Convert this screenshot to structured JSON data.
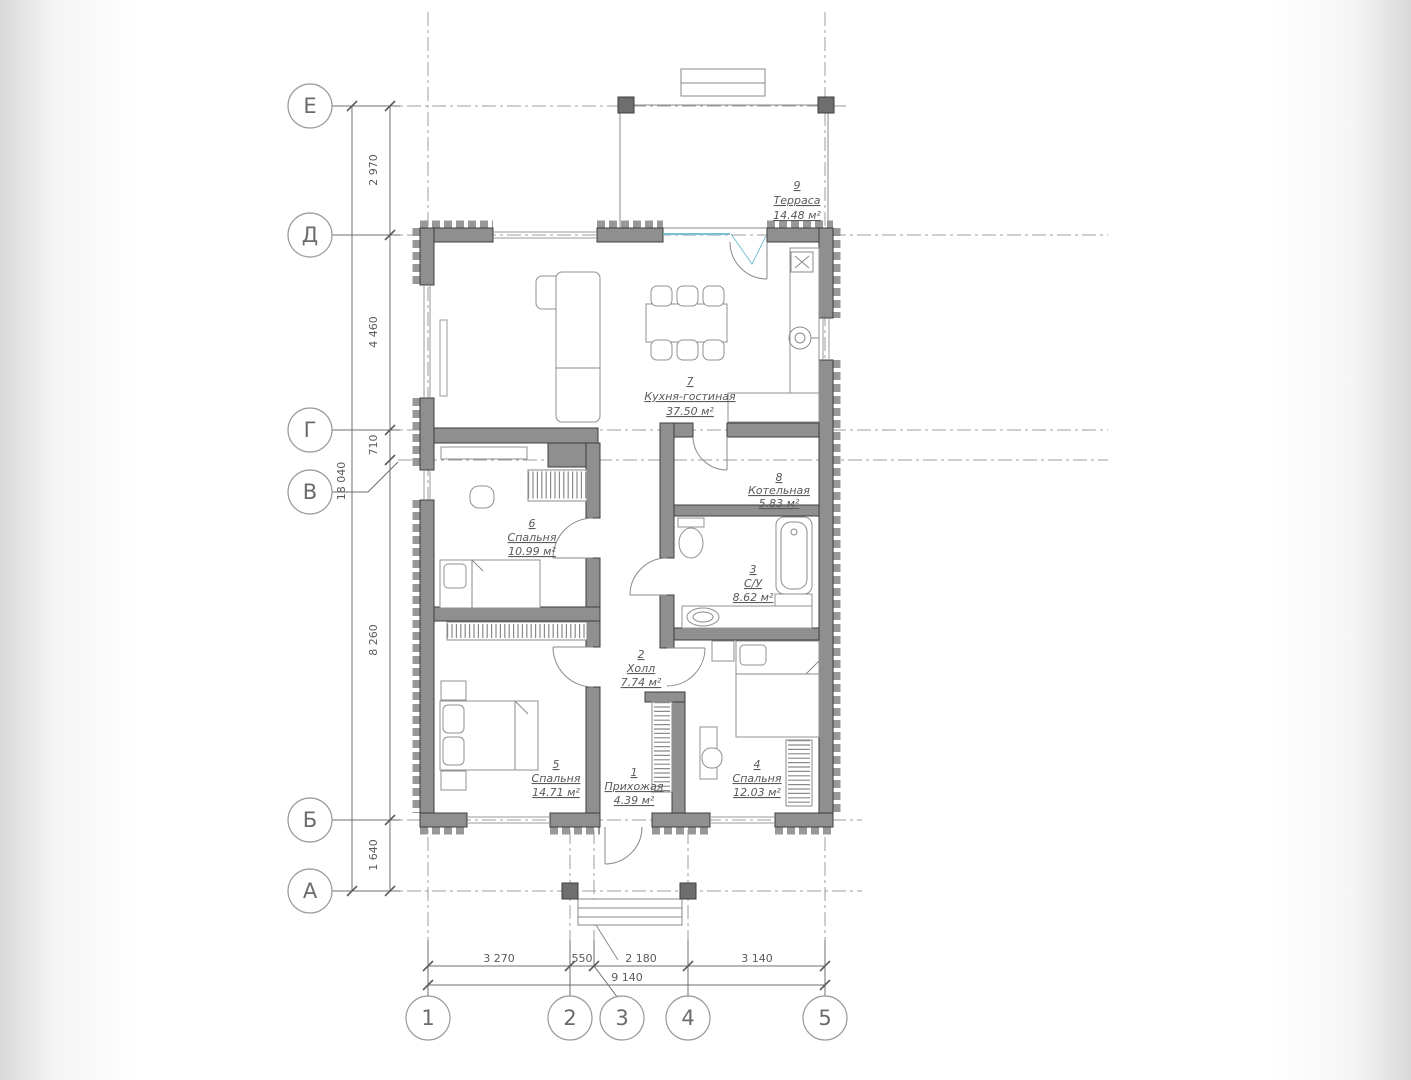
{
  "plan": {
    "rooms": [
      {
        "number": "1",
        "name": "Прихожая",
        "area": "4.39 м²"
      },
      {
        "number": "2",
        "name": "Холл",
        "area": "7.74 м²"
      },
      {
        "number": "3",
        "name": "С/У",
        "area": "8.62 м²"
      },
      {
        "number": "4",
        "name": "Спальня",
        "area": "12.03 м²"
      },
      {
        "number": "5",
        "name": "Спальня",
        "area": "14.71 м²"
      },
      {
        "number": "6",
        "name": "Спальня",
        "area": "10.99 м²"
      },
      {
        "number": "7",
        "name": "Кухня-гостиная",
        "area": "37.50 м²"
      },
      {
        "number": "8",
        "name": "Котельная",
        "area": "5.83 м²"
      },
      {
        "number": "9",
        "name": "Терраса",
        "area": "14.48 м²"
      }
    ],
    "axes": {
      "rows": [
        "Е",
        "Д",
        "Г",
        "В",
        "Б",
        "А"
      ],
      "cols": [
        "1",
        "2",
        "3",
        "4",
        "5"
      ]
    },
    "dims": {
      "v_segments": [
        "2 970",
        "4 460",
        "710",
        "8 260",
        "1 640"
      ],
      "v_total": "18 040",
      "h_segments": [
        "3 270",
        "550",
        "2 180",
        "3 140"
      ],
      "h_total": "9 140"
    },
    "colors": {
      "wall_fill": "#8f8f8f",
      "glazing_accent": "#7ac0d4"
    }
  }
}
